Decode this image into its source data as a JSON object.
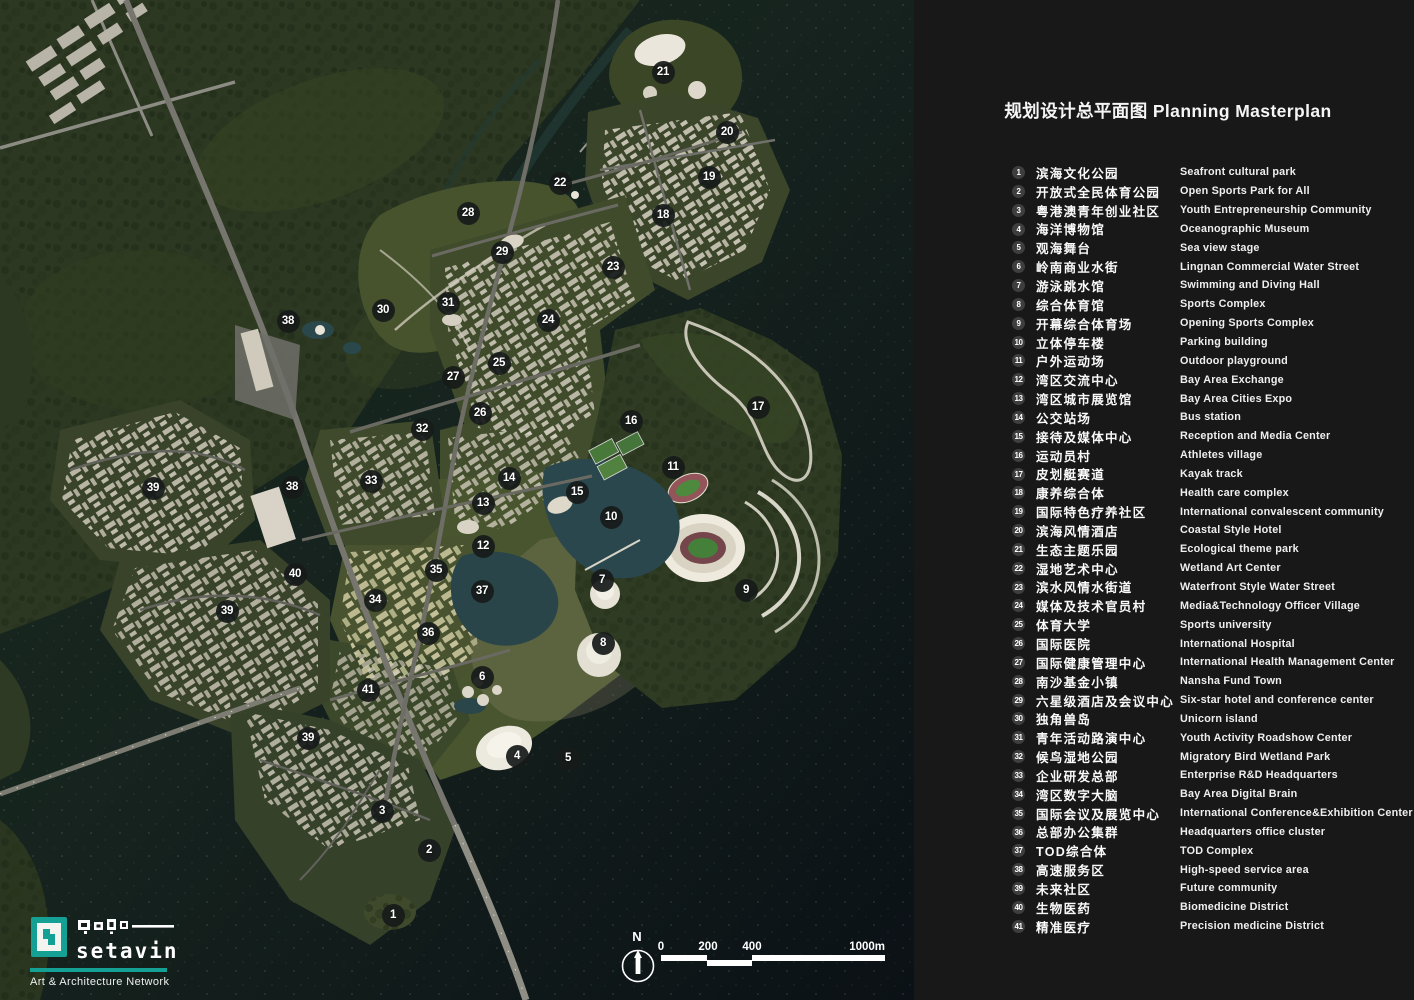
{
  "panel": {
    "title": "规划设计总平面图 Planning Masterplan",
    "legend": [
      {
        "num": "1",
        "zh": "滨海文化公园",
        "en": "Seafront cultural park"
      },
      {
        "num": "2",
        "zh": "开放式全民体育公园",
        "en": "Open Sports Park for All"
      },
      {
        "num": "3",
        "zh": "粤港澳青年创业社区",
        "en": "Youth Entrepreneurship Community"
      },
      {
        "num": "4",
        "zh": "海洋博物馆",
        "en": "Oceanographic Museum"
      },
      {
        "num": "5",
        "zh": "观海舞台",
        "en": "Sea view stage"
      },
      {
        "num": "6",
        "zh": "岭南商业水街",
        "en": "Lingnan Commercial Water Street"
      },
      {
        "num": "7",
        "zh": "游泳跳水馆",
        "en": "Swimming and Diving Hall"
      },
      {
        "num": "8",
        "zh": "综合体育馆",
        "en": "Sports Complex"
      },
      {
        "num": "9",
        "zh": "开幕综合体育场",
        "en": "Opening Sports Complex"
      },
      {
        "num": "10",
        "zh": "立体停车楼",
        "en": "Parking building"
      },
      {
        "num": "11",
        "zh": "户外运动场",
        "en": "Outdoor playground"
      },
      {
        "num": "12",
        "zh": "湾区交流中心",
        "en": "Bay Area Exchange"
      },
      {
        "num": "13",
        "zh": "湾区城市展览馆",
        "en": "Bay Area Cities Expo"
      },
      {
        "num": "14",
        "zh": "公交站场",
        "en": "Bus station"
      },
      {
        "num": "15",
        "zh": "接待及媒体中心",
        "en": "Reception and Media Center"
      },
      {
        "num": "16",
        "zh": "运动员村",
        "en": "Athletes village"
      },
      {
        "num": "17",
        "zh": "皮划艇赛道",
        "en": "Kayak track"
      },
      {
        "num": "18",
        "zh": "康养综合体",
        "en": "Health care complex"
      },
      {
        "num": "19",
        "zh": "国际特色疗养社区",
        "en": "International convalescent community"
      },
      {
        "num": "20",
        "zh": "滨海风情酒店",
        "en": "Coastal Style Hotel"
      },
      {
        "num": "21",
        "zh": "生态主题乐园",
        "en": "Ecological theme park"
      },
      {
        "num": "22",
        "zh": "湿地艺术中心",
        "en": "Wetland Art Center"
      },
      {
        "num": "23",
        "zh": "滨水风情水街道",
        "en": "Waterfront Style Water Street"
      },
      {
        "num": "24",
        "zh": "媒体及技术官员村",
        "en": "Media&Technology Officer Village"
      },
      {
        "num": "25",
        "zh": "体育大学",
        "en": "Sports university"
      },
      {
        "num": "26",
        "zh": "国际医院",
        "en": "International Hospital"
      },
      {
        "num": "27",
        "zh": "国际健康管理中心",
        "en": "International Health Management Center"
      },
      {
        "num": "28",
        "zh": "南沙基金小镇",
        "en": "Nansha Fund Town"
      },
      {
        "num": "29",
        "zh": "六星级酒店及会议中心",
        "en": "Six-star hotel and conference center"
      },
      {
        "num": "30",
        "zh": "独角兽岛",
        "en": "Unicorn island"
      },
      {
        "num": "31",
        "zh": "青年活动路演中心",
        "en": "Youth Activity Roadshow Center"
      },
      {
        "num": "32",
        "zh": "候鸟湿地公园",
        "en": "Migratory Bird Wetland Park"
      },
      {
        "num": "33",
        "zh": "企业研发总部",
        "en": "Enterprise R&D Headquarters"
      },
      {
        "num": "34",
        "zh": "湾区数字大脑",
        "en": "Bay Area Digital Brain"
      },
      {
        "num": "35",
        "zh": "国际会议及展览中心",
        "en": "International Conference&Exhibition Center"
      },
      {
        "num": "36",
        "zh": "总部办公集群",
        "en": "Headquarters office cluster"
      },
      {
        "num": "37",
        "zh": "TOD综合体",
        "en": "TOD Complex"
      },
      {
        "num": "38",
        "zh": "高速服务区",
        "en": "High-speed service area"
      },
      {
        "num": "39",
        "zh": "未来社区",
        "en": "Future community"
      },
      {
        "num": "40",
        "zh": "生物医药",
        "en": "Biomedicine District"
      },
      {
        "num": "41",
        "zh": "精准医疗",
        "en": "Precision medicine District"
      }
    ]
  },
  "map": {
    "north_label": "N",
    "scale_bar": {
      "labels": [
        "0",
        "200",
        "400",
        "1000m"
      ]
    },
    "markers": [
      {
        "n": "1",
        "x": 393,
        "y": 915
      },
      {
        "n": "2",
        "x": 429,
        "y": 850
      },
      {
        "n": "3",
        "x": 382,
        "y": 811
      },
      {
        "n": "4",
        "x": 517,
        "y": 756
      },
      {
        "n": "5",
        "x": 568,
        "y": 758
      },
      {
        "n": "6",
        "x": 482,
        "y": 677
      },
      {
        "n": "7",
        "x": 602,
        "y": 580
      },
      {
        "n": "8",
        "x": 603,
        "y": 643
      },
      {
        "n": "9",
        "x": 746,
        "y": 590
      },
      {
        "n": "10",
        "x": 611,
        "y": 517
      },
      {
        "n": "11",
        "x": 673,
        "y": 467
      },
      {
        "n": "12",
        "x": 483,
        "y": 546
      },
      {
        "n": "13",
        "x": 483,
        "y": 503
      },
      {
        "n": "14",
        "x": 509,
        "y": 478
      },
      {
        "n": "15",
        "x": 577,
        "y": 492
      },
      {
        "n": "16",
        "x": 631,
        "y": 421
      },
      {
        "n": "17",
        "x": 758,
        "y": 407
      },
      {
        "n": "18",
        "x": 663,
        "y": 215
      },
      {
        "n": "19",
        "x": 709,
        "y": 177
      },
      {
        "n": "20",
        "x": 727,
        "y": 132
      },
      {
        "n": "21",
        "x": 663,
        "y": 72
      },
      {
        "n": "22",
        "x": 560,
        "y": 183
      },
      {
        "n": "23",
        "x": 613,
        "y": 267
      },
      {
        "n": "24",
        "x": 548,
        "y": 320
      },
      {
        "n": "25",
        "x": 499,
        "y": 363
      },
      {
        "n": "26",
        "x": 480,
        "y": 413
      },
      {
        "n": "27",
        "x": 453,
        "y": 377
      },
      {
        "n": "28",
        "x": 468,
        "y": 213
      },
      {
        "n": "29",
        "x": 502,
        "y": 252
      },
      {
        "n": "30",
        "x": 383,
        "y": 310
      },
      {
        "n": "31",
        "x": 448,
        "y": 303
      },
      {
        "n": "32",
        "x": 422,
        "y": 429
      },
      {
        "n": "33",
        "x": 371,
        "y": 481
      },
      {
        "n": "34",
        "x": 375,
        "y": 600
      },
      {
        "n": "35",
        "x": 436,
        "y": 570
      },
      {
        "n": "36",
        "x": 428,
        "y": 633
      },
      {
        "n": "37",
        "x": 482,
        "y": 591
      },
      {
        "n": "38",
        "x": 288,
        "y": 321
      },
      {
        "n": "38",
        "x": 292,
        "y": 487
      },
      {
        "n": "39",
        "x": 153,
        "y": 488
      },
      {
        "n": "39",
        "x": 227,
        "y": 611
      },
      {
        "n": "39",
        "x": 308,
        "y": 738
      },
      {
        "n": "40",
        "x": 295,
        "y": 574
      },
      {
        "n": "41",
        "x": 368,
        "y": 690
      }
    ]
  },
  "logo": {
    "wordmark": "setavin",
    "tagline": "Art & Architecture Network",
    "accent_color": "#14a094"
  },
  "colors": {
    "panel_bg": "#181818",
    "marker_bg": "#171b1a",
    "badge_bg": "#3e3e3e",
    "water_dark": "#0e1417",
    "land_green": "#2c3822"
  }
}
